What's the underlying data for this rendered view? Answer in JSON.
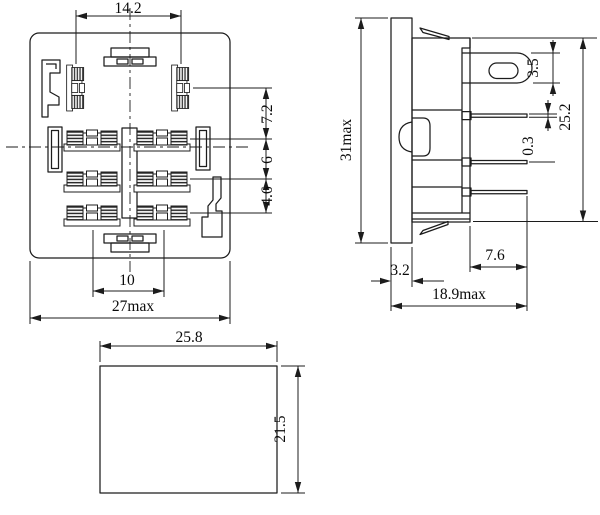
{
  "front_view": {
    "dims": {
      "top_pin_spacing": "14.2",
      "row_gap_a": "7.2",
      "row_gap_b": "6",
      "row_gap_c": "4.6",
      "bottom_pin_spacing": "10",
      "overall_width": "27max"
    }
  },
  "side_view": {
    "dims": {
      "overall_height": "31max",
      "slot_height": "3.5",
      "pin_thickness": "0.3",
      "body_height": "25.2",
      "flange_thickness": "3.2",
      "pin_length": "7.6",
      "overall_depth": "18.9max"
    }
  },
  "bottom_view": {
    "dims": {
      "width": "25.8",
      "height": "21.5"
    }
  }
}
